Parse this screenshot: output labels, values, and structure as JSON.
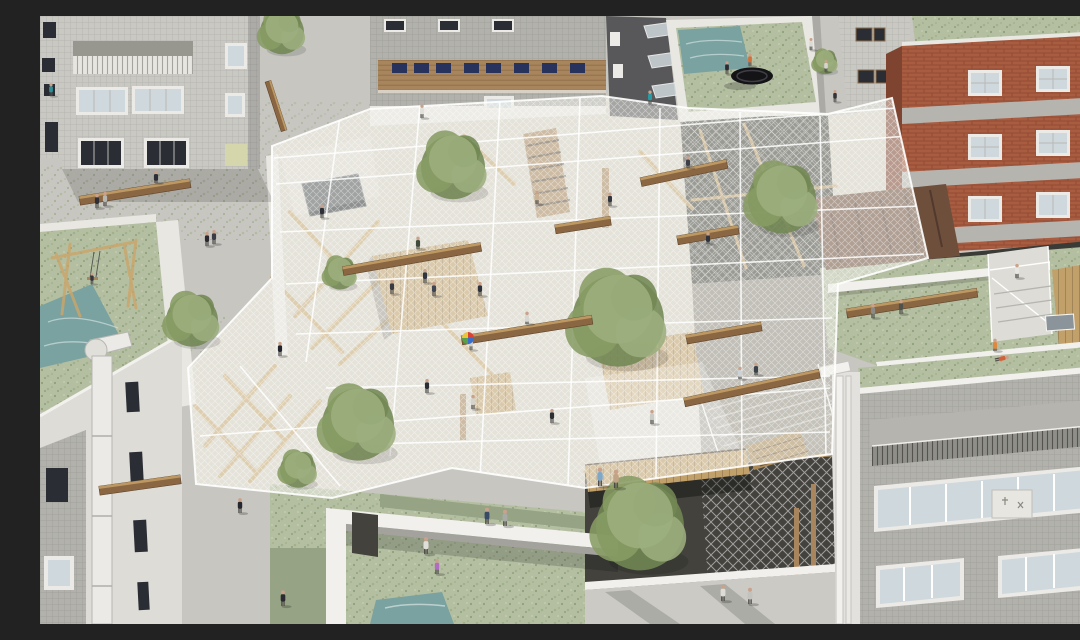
{
  "scene": {
    "alt": "Aerial architectural rendering of a dense city block: a translucent net canopy with wooden beams and benches is stretched between gray tiled apartment buildings and a red brick building; trees grow through the net, green moss covers surrounding rooftops with small ponds, a trampoline and a swing, and dozens of small figures walk, sit and play across the canopy, rooftops and sunken courtyards.",
    "palette": {
      "concrete": "#c7c6c0",
      "ground": "#d6d2c6",
      "tileLight": "#c9c8c3",
      "tileMid": "#b2b1ab",
      "facadeWhite": "#dddcd7",
      "parapet": "#e8e7e2",
      "wood": "#a8855c",
      "woodBeam": "#8a6642",
      "woodLight": "#c9a56b",
      "woodDeck": "#c2a06a",
      "brick": "#a85c40",
      "brickShadow": "#7e4430",
      "band": "#b6b4af",
      "moss": "#b4bfa2",
      "mossDark": "#96a385",
      "water": "#7aa2a0",
      "asphalt": "#58585a",
      "pit": "#43423d",
      "gravel": "#918d82",
      "rust": "#6e4f3c",
      "slab": "#cbcac4",
      "windowDark": "#2a2d33",
      "windowBlue": "#27335c",
      "glass": "#cfd8dc",
      "white": "#f1f0ec",
      "treeA": "#879c64",
      "treeB": "#728853",
      "treeC": "#9cae7d",
      "skin": "#c9a28c"
    },
    "trees": [
      [
        242,
        14,
        22
      ],
      [
        413,
        148,
        32
      ],
      [
        578,
        300,
        46
      ],
      [
        742,
        180,
        34
      ],
      [
        300,
        256,
        16
      ],
      [
        152,
        302,
        26
      ],
      [
        600,
        506,
        44
      ],
      [
        318,
        405,
        36
      ],
      [
        258,
        452,
        18
      ],
      [
        785,
        45,
        12
      ]
    ],
    "beams": [
      [
        95,
        176,
        112,
        -9
      ],
      [
        372,
        243,
        140,
        -10
      ],
      [
        543,
        209,
        56,
        -9
      ],
      [
        644,
        157,
        88,
        -12
      ],
      [
        668,
        219,
        62,
        -10
      ],
      [
        487,
        314,
        132,
        -9
      ],
      [
        684,
        317,
        76,
        -10
      ],
      [
        712,
        372,
        138,
        -12
      ],
      [
        100,
        469,
        82,
        -8
      ],
      [
        872,
        287,
        132,
        -9
      ],
      [
        236,
        90,
        52,
        72,
        6
      ]
    ],
    "people": [
      [
        11,
        80,
        "#2e8f96",
        0.9
      ],
      [
        57,
        192,
        "#2e2e34",
        1
      ],
      [
        65,
        190,
        "#b8b6b0",
        1
      ],
      [
        167,
        230,
        "#2a2a30",
        1
      ],
      [
        174,
        228,
        "#3c3c44",
        1
      ],
      [
        116,
        167,
        "#2e2e36",
        1,
        "sit"
      ],
      [
        240,
        340,
        "#23232b",
        1
      ],
      [
        282,
        202,
        "#2e3038",
        0.95
      ],
      [
        382,
        102,
        "#e2e0da",
        0.95
      ],
      [
        497,
        188,
        "#c9b394",
        0.95
      ],
      [
        570,
        190,
        "#34363e",
        0.95
      ],
      [
        687,
        58,
        "#2c2c32",
        0.9
      ],
      [
        710,
        50,
        "#d2703a",
        0.9
      ],
      [
        771,
        34,
        "#dcdad4",
        0.85
      ],
      [
        786,
        56,
        "#d6d4ce",
        0.85
      ],
      [
        795,
        86,
        "#34343a",
        0.85
      ],
      [
        610,
        88,
        "#2a9aa2",
        0.95
      ],
      [
        648,
        152,
        "#3c4046",
        0.95,
        "sit"
      ],
      [
        668,
        228,
        "#2f333b",
        0.95,
        "sit"
      ],
      [
        378,
        233,
        "#3f4a3a",
        1,
        "sit"
      ],
      [
        352,
        278,
        "#3a3a42",
        1
      ],
      [
        385,
        267,
        "#303642",
        1
      ],
      [
        394,
        280,
        "#3e4450",
        1
      ],
      [
        440,
        280,
        "#303239",
        1
      ],
      [
        487,
        308,
        "#d8d6d0",
        1,
        "sit"
      ],
      [
        431,
        334,
        "#d0d0cc",
        0.9
      ],
      [
        433,
        393,
        "#d6d3cd",
        1
      ],
      [
        387,
        377,
        "#2b2d35",
        1
      ],
      [
        512,
        407,
        "#2c2e34",
        1
      ],
      [
        612,
        408,
        "#caccc8",
        1
      ],
      [
        700,
        363,
        "#ccd2d6",
        1,
        "sit"
      ],
      [
        716,
        359,
        "#3c4248",
        1,
        "sit"
      ],
      [
        560,
        470,
        "#7fa8c8",
        1.3
      ],
      [
        576,
        472,
        "#c0a284",
        1.3
      ],
      [
        447,
        508,
        "#384a66",
        1.15
      ],
      [
        465,
        510,
        "#a8aaa6",
        1.15
      ],
      [
        386,
        538,
        "#e0ded8",
        1.2
      ],
      [
        397,
        558,
        "#b06cc0",
        1.05
      ],
      [
        243,
        590,
        "#2a2a30",
        1.1
      ],
      [
        200,
        497,
        "#26262e",
        1.05
      ],
      [
        52,
        268,
        "#35353d",
        0.8
      ],
      [
        683,
        585,
        "#dedcd6",
        1.15
      ],
      [
        710,
        588,
        "#c2c2be",
        1.15
      ],
      [
        833,
        302,
        "#8b8b83",
        1
      ],
      [
        861,
        298,
        "#4e524a",
        1
      ],
      [
        977,
        262,
        "#e6e6e2",
        1
      ],
      [
        1043,
        262,
        "#d492a4",
        0.95,
        "sit"
      ],
      [
        955,
        335,
        "#e08840",
        1,
        "sit"
      ],
      [
        955,
        344,
        "#d4603a",
        1,
        "lie"
      ]
    ]
  }
}
